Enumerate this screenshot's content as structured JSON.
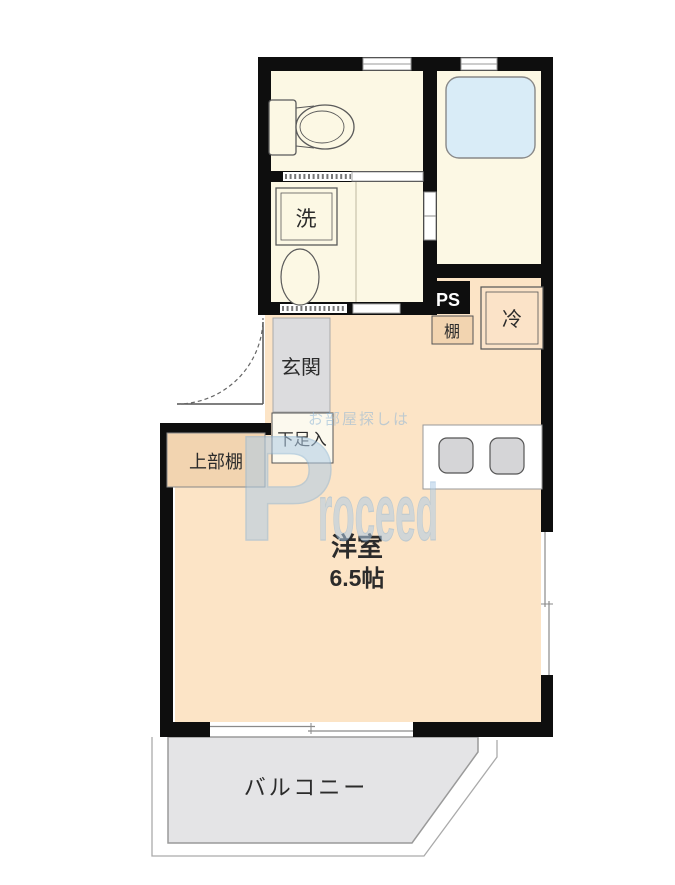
{
  "floorplan": {
    "rooms": {
      "main_room": {
        "name": "洋室",
        "size": "6.5帖"
      },
      "balcony": {
        "label": "バルコニー"
      },
      "entrance": {
        "label": "玄関"
      },
      "shoe_cabinet": {
        "label": "下足入"
      },
      "upper_shelf": {
        "label": "上部棚"
      },
      "washer": {
        "label": "洗"
      },
      "pipe_space": {
        "label": "PS"
      },
      "shelf": {
        "label": "棚"
      },
      "refrigerator": {
        "label": "冷"
      }
    },
    "watermark": {
      "logo_initial": "P",
      "logo_rest": "roceed",
      "tagline": "お部屋探しは"
    },
    "colors": {
      "wall_black": "#0e0e0e",
      "main_room_peach": "#fce4c6",
      "service_cream": "#fcf8e4",
      "bathtub_blue": "#d9ecf7",
      "entrance_gray": "#dcdcde",
      "balcony_gray": "#e4e4e6",
      "shelf_tan": "#f2d4b0",
      "watermark_blue": "#aecce6"
    }
  }
}
